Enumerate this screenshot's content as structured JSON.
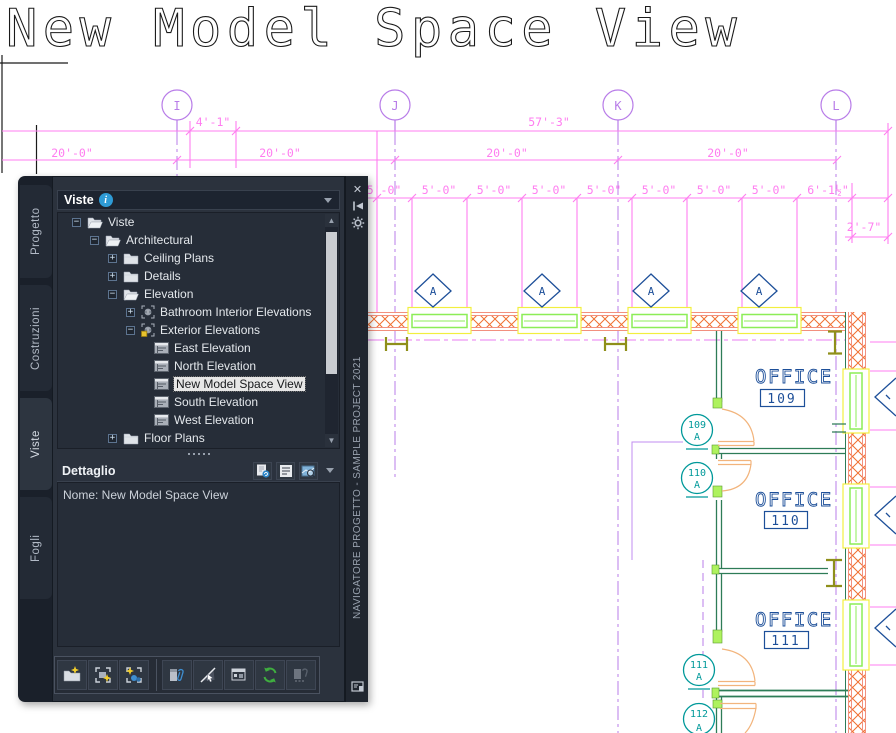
{
  "drawing": {
    "title": "New Model Space View",
    "grid": [
      "I",
      "J",
      "K",
      "L"
    ],
    "dims": {
      "r1": [
        "4'-1\"",
        "57'-3\""
      ],
      "r2": [
        "20'-0\"",
        "20'-0\"",
        "20'-0\"",
        "20'-0\""
      ],
      "r3": [
        "5'-0\"",
        "5'-0\"",
        "5'-0\"",
        "5'-0\"",
        "5'-0\"",
        "5'-0\"",
        "5'-0\"",
        "5'-0\""
      ],
      "r3b": "6'-1½\"",
      "r4": "2'-7\""
    },
    "window_tag": "A",
    "rooms": [
      {
        "label": "OFFICE",
        "number": "109"
      },
      {
        "label": "OFFICE",
        "number": "110"
      },
      {
        "label": "OFFICE",
        "number": "111"
      }
    ],
    "door_tags": [
      {
        "number": "109",
        "letter": "A"
      },
      {
        "number": "110",
        "letter": "A"
      },
      {
        "number": "111",
        "letter": "A"
      },
      {
        "number": "112",
        "letter": "A"
      }
    ],
    "colors": {
      "dimension": "#ff7df0",
      "grid": "#b87ce8",
      "hatch": "#f07030",
      "wall": "#f2907e",
      "window_frame": "#8ced57",
      "window_trim": "#f2ef3f",
      "annotation": "#1d4f99",
      "door_tag": "#00999a",
      "door": "#f2b47c",
      "interior_wall": "#2e7c57",
      "column": "#8f8f1a"
    }
  },
  "palette": {
    "tabs": [
      {
        "label": "Progetto",
        "active": false
      },
      {
        "label": "Costruzioni",
        "active": false
      },
      {
        "label": "Viste",
        "active": true
      },
      {
        "label": "Fogli",
        "active": false
      }
    ],
    "panel_header": {
      "label": "Viste"
    },
    "tree": [
      {
        "label": "Viste",
        "level": 0,
        "expand": "minus",
        "icon": "folder-open",
        "selected": false
      },
      {
        "label": "Architectural",
        "level": 1,
        "expand": "minus",
        "icon": "folder-open",
        "selected": false
      },
      {
        "label": "Ceiling Plans",
        "level": 2,
        "expand": "plus",
        "icon": "folder",
        "selected": false
      },
      {
        "label": "Details",
        "level": 2,
        "expand": "plus",
        "icon": "folder",
        "selected": false
      },
      {
        "label": "Elevation",
        "level": 2,
        "expand": "minus",
        "icon": "folder-open",
        "selected": false
      },
      {
        "label": "Bathroom Interior Elevations",
        "level": 3,
        "expand": "plus",
        "icon": "elevation",
        "selected": false
      },
      {
        "label": "Exterior Elevations",
        "level": 3,
        "expand": "minus",
        "icon": "elevation-new",
        "selected": false
      },
      {
        "label": "East Elevation",
        "level": 4,
        "expand": "none",
        "icon": "view",
        "selected": false
      },
      {
        "label": "North Elevation",
        "level": 4,
        "expand": "none",
        "icon": "view",
        "selected": false
      },
      {
        "label": "New Model Space View",
        "level": 4,
        "expand": "none",
        "icon": "view",
        "selected": true
      },
      {
        "label": "South Elevation",
        "level": 4,
        "expand": "none",
        "icon": "view",
        "selected": false
      },
      {
        "label": "West Elevation",
        "level": 4,
        "expand": "none",
        "icon": "view",
        "selected": false
      },
      {
        "label": "Floor Plans",
        "level": 2,
        "expand": "plus",
        "icon": "folder",
        "selected": false
      }
    ],
    "detail": {
      "label": "Dettaglio",
      "content": "Nome: New Model Space View"
    },
    "detail_icons": [
      "preview-refresh",
      "detail-list",
      "preview-image"
    ],
    "toolbar_icons": [
      "new-category",
      "new-view",
      "new-model-space-view",
      "attach-xref",
      "hide",
      "properties",
      "refresh-project",
      "repath-xref"
    ],
    "titlebar": {
      "vertical_title": "NAVIGATORE PROGETTO - SAMPLE PROJECT 2021"
    }
  }
}
